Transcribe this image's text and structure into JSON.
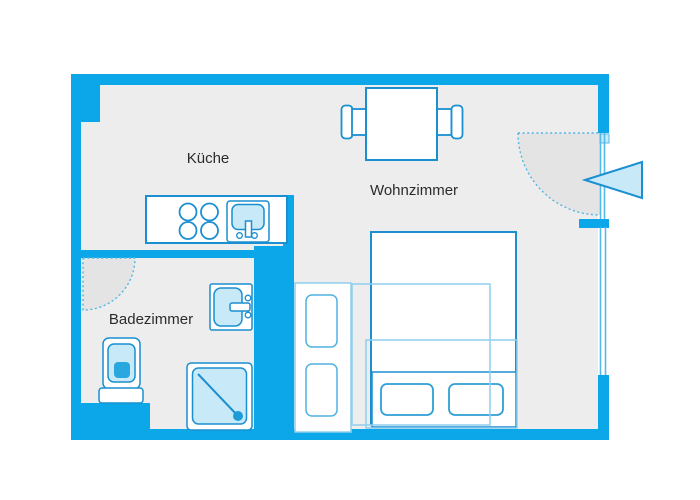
{
  "page": {
    "type": "apartment-floor-plan",
    "background": "#FFFFFF"
  },
  "rooms": {
    "kueche": {
      "label": "Küche"
    },
    "wohnzimmer": {
      "label": "Wohnzimmer"
    },
    "badezimmer": {
      "label": "Badezimmer"
    }
  },
  "colors": {
    "wall_blue": "#0BA7E9",
    "floor_gray": "#EDEDED",
    "furniture_outline_dark": "#1A8FD1",
    "furniture_outline_light": "#8FCFEE",
    "fixture_fill_light_blue": "#C8E9F8",
    "door_swing_gray": "#E4E4E4",
    "accent_blue": "#29A8E0",
    "label_text": "#2B2B2B"
  }
}
